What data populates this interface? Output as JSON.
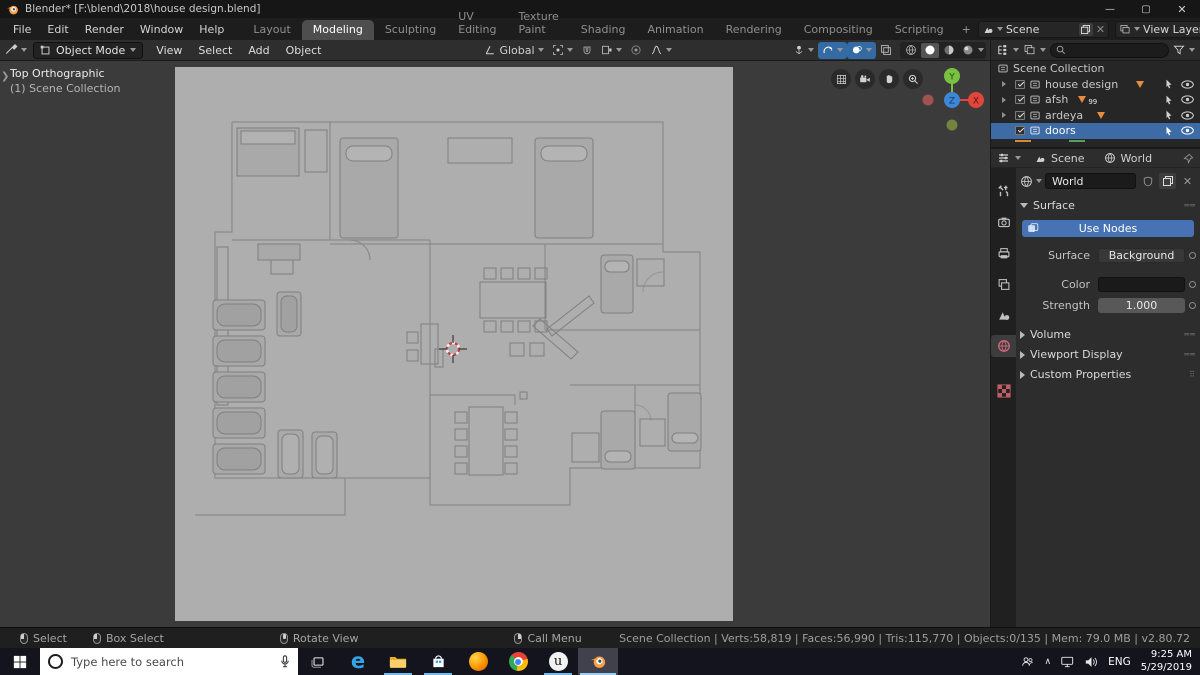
{
  "window": {
    "title": "Blender* [F:\\blend\\2018\\house design.blend]",
    "controls": {
      "minimize": "—",
      "maximize": "▢",
      "close": "✕"
    }
  },
  "menubar": {
    "menus": [
      "File",
      "Edit",
      "Render",
      "Window",
      "Help"
    ],
    "tabs": [
      "Layout",
      "Modeling",
      "Sculpting",
      "UV Editing",
      "Texture Paint",
      "Shading",
      "Animation",
      "Rendering",
      "Compositing",
      "Scripting"
    ],
    "active_tab": "Modeling",
    "tab_plus": "+",
    "scene_selector": "Scene",
    "view_layer_selector": "View Layer"
  },
  "toolbar": {
    "mode": "Object Mode",
    "menus": [
      "View",
      "Select",
      "Add",
      "Object"
    ],
    "orientation": "Global"
  },
  "viewport": {
    "view_label": "Top Orthographic",
    "collection_label": "(1) Scene Collection",
    "axis_x": "X",
    "axis_y": "Y",
    "axis_z": "Z"
  },
  "outliner": {
    "root": "Scene Collection",
    "items": [
      {
        "label": "house design"
      },
      {
        "label": "afsh",
        "count": "99"
      },
      {
        "label": "ardeya"
      },
      {
        "label": "doors"
      }
    ]
  },
  "properties": {
    "breadcrumb_scene": "Scene",
    "breadcrumb_world": "World",
    "datablock_name": "World",
    "surface_section": "Surface",
    "use_nodes": "Use Nodes",
    "surface_label": "Surface",
    "surface_value": "Background",
    "color_label": "Color",
    "strength_label": "Strength",
    "strength_value": "1.000",
    "volume_section": "Volume",
    "viewport_display_section": "Viewport Display",
    "custom_properties_section": "Custom Properties"
  },
  "statusbar": {
    "hint_select": "Select",
    "hint_box_select": "Box Select",
    "hint_rotate_view": "Rotate View",
    "hint_call_menu": "Call Menu",
    "stats": "Scene Collection | Verts:58,819 | Faces:56,990 | Tris:115,770 | Objects:0/135 | Mem: 79.0 MB | v2.80.72"
  },
  "taskbar": {
    "search_placeholder": "Type here to search",
    "language": "ENG",
    "time": "9:25 AM",
    "date": "5/29/2019"
  },
  "colors": {
    "accent_blue": "#4772b3",
    "selection_blue": "#3d6ba6",
    "blender_orange": "#ff9f3e",
    "badge_orange": "#e78b3c"
  }
}
